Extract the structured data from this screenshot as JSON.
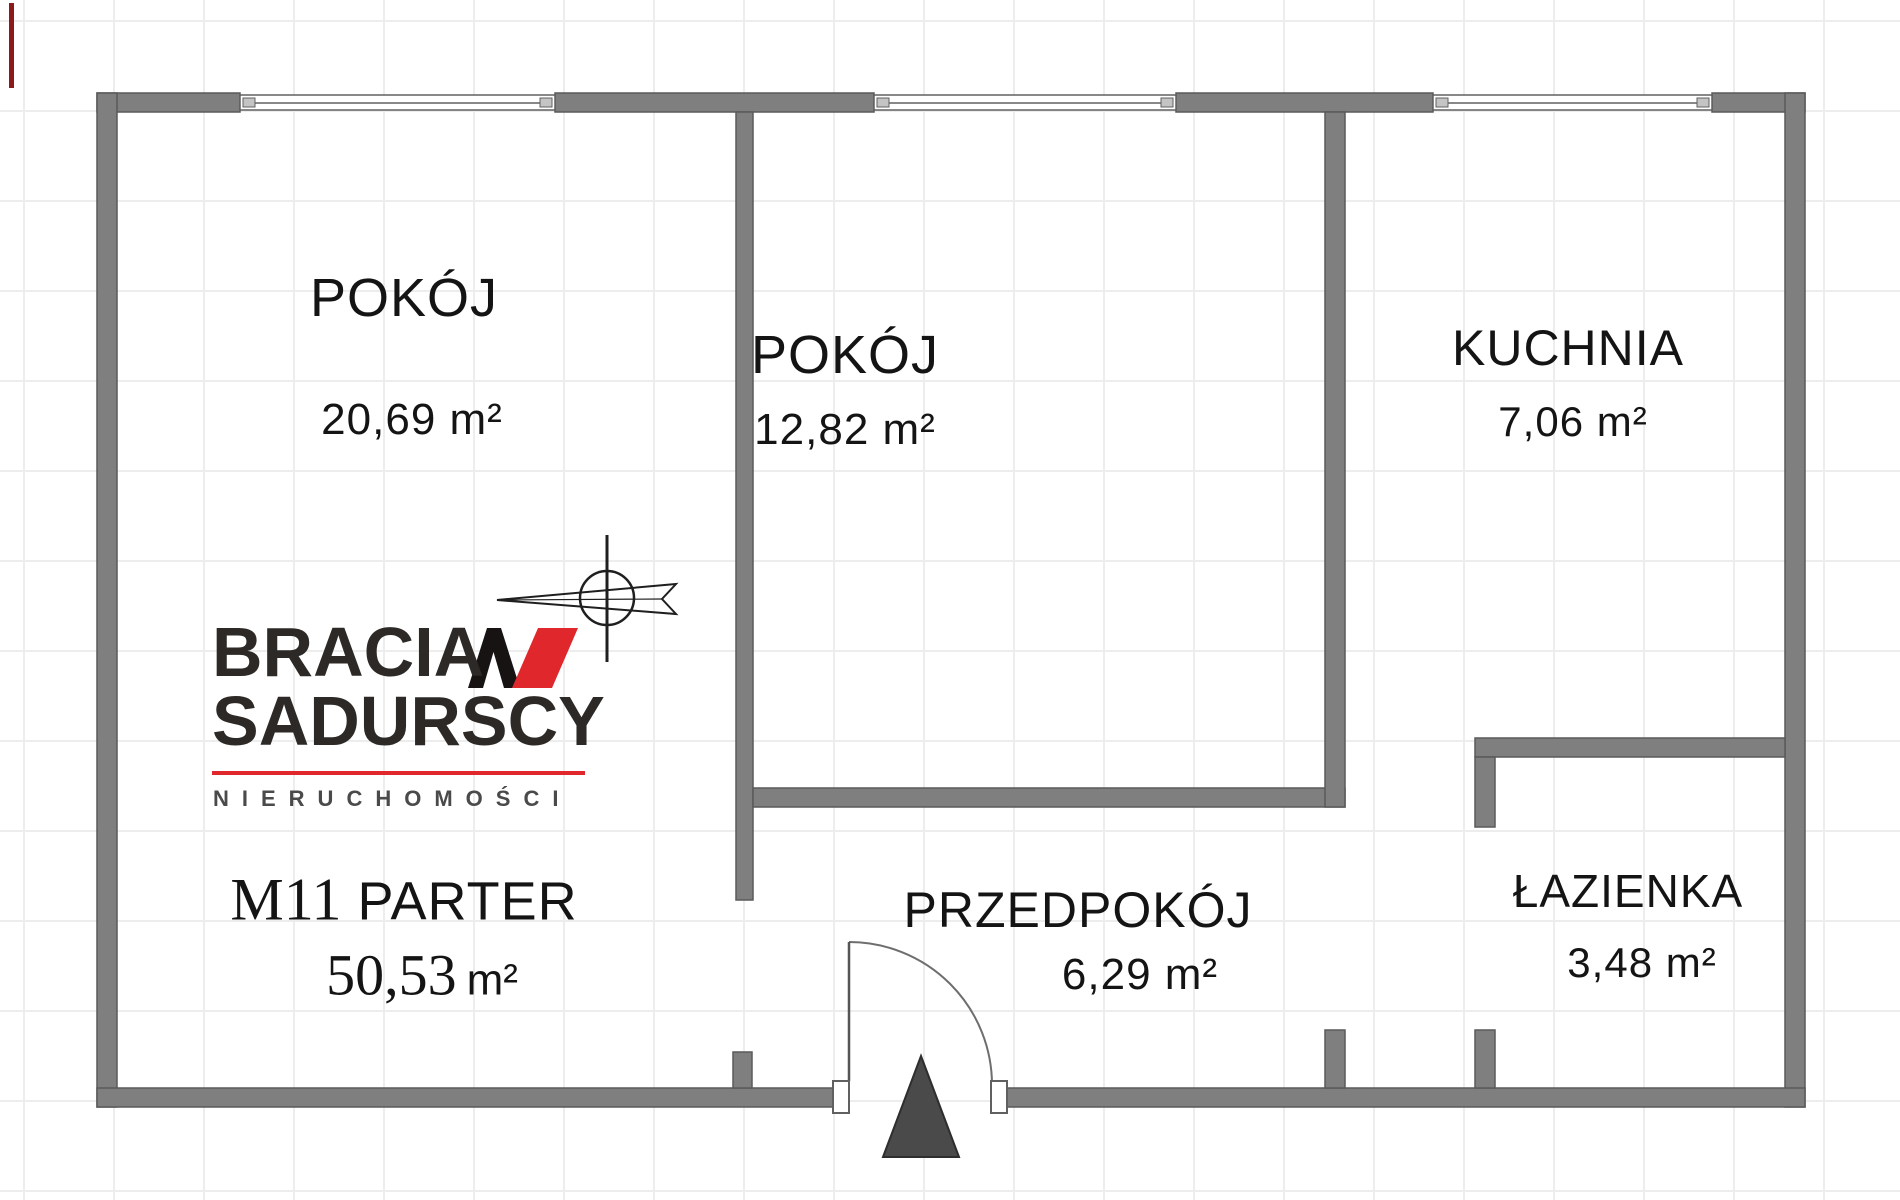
{
  "colors": {
    "wall": "#7f7f7f",
    "wall-outline": "#5a5a5a",
    "accent": "#e0282c",
    "text": "#141414",
    "grid": "#ededed",
    "triangle": "#4a4a4a",
    "logo-dark": "#2d2926",
    "logo-gray": "#4a4a4a"
  },
  "rooms": [
    {
      "id": "pokoj-1",
      "name": "POKÓJ",
      "area": "20,69 m²"
    },
    {
      "id": "pokoj-2",
      "name": "POKÓJ",
      "area": "12,82 m²"
    },
    {
      "id": "kuchnia",
      "name": "KUCHNIA",
      "area": "7,06 m²"
    },
    {
      "id": "przedpokoj",
      "name": "PRZEDPOKÓJ",
      "area": "6,29 m²"
    },
    {
      "id": "lazienka",
      "name": "ŁAZIENKA",
      "area": "3,48 m²"
    }
  ],
  "unit": {
    "label_serif": "M11",
    "label_sans": "PARTER",
    "area_value": "50,53",
    "area_unit": "m²"
  },
  "logo": {
    "line1": "BRACIA",
    "line2": "SADURSCY",
    "tagline": "NIERUCHOMOŚCI"
  }
}
